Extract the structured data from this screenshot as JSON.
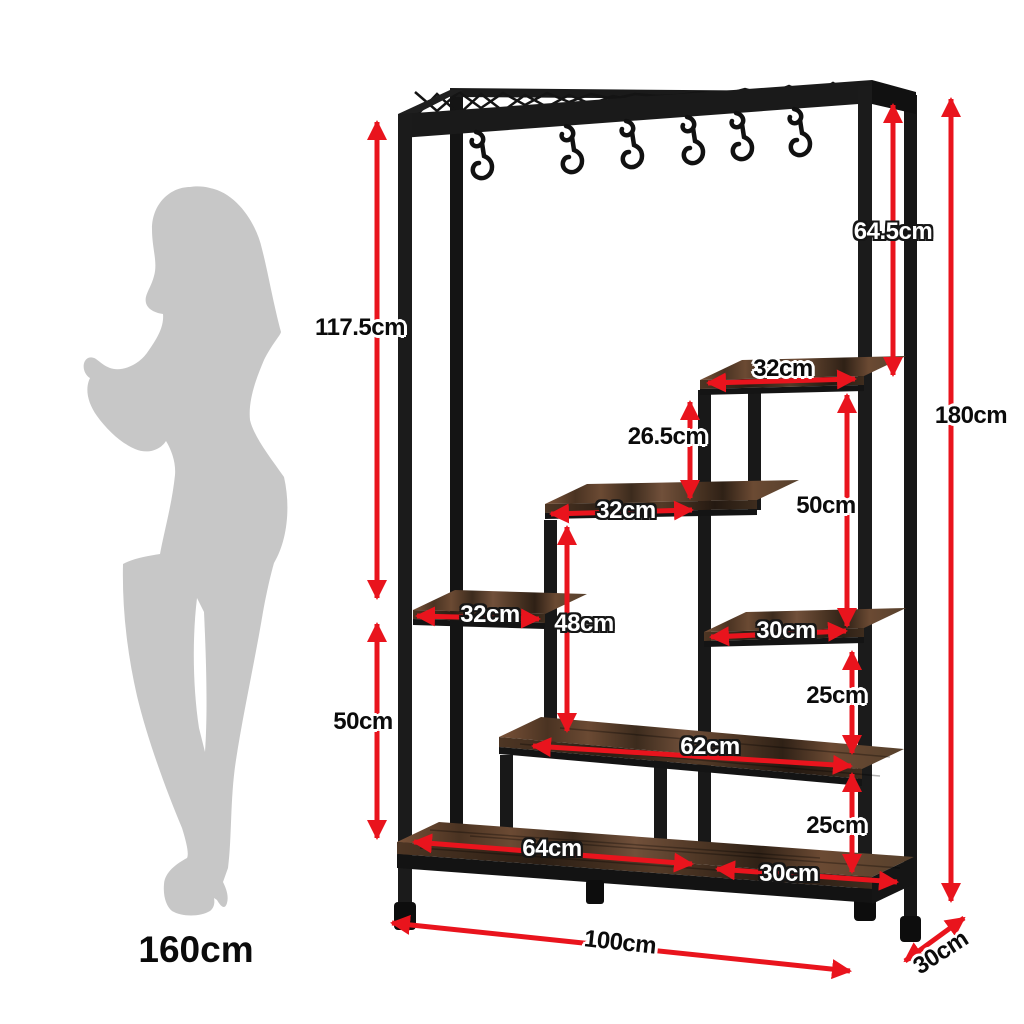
{
  "diagram": {
    "type": "furniture-dimension-diagram",
    "product": "industrial shelf rack with hanging hooks and person silhouette for scale",
    "background": "#ffffff",
    "hook_count": 6
  },
  "colors": {
    "arrow_red": "#e9141d",
    "metal_black": "#1a1a1a",
    "wood_brown": "#6b4a33",
    "silhouette_gray": "#c7c7c7",
    "label_dark": "#0b0b0b",
    "label_light": "#ffffff"
  },
  "labels": {
    "height_upper_section": "117.5cm",
    "height_lower_left": "50cm",
    "height_hook_section": "64.5cm",
    "height_total": "180cm",
    "width_top_shelf": "32cm",
    "gap_top_to_middle_shelf": "26.5cm",
    "height_right_tier": "50cm",
    "width_middle_shelf": "32cm",
    "width_left_shelf": "32cm",
    "height_middle_tier": "48cm",
    "width_right_shelf": "30cm",
    "gap_right_upper": "25cm",
    "width_long_shelf": "62cm",
    "gap_right_lower": "25cm",
    "width_bottom_left_section": "64cm",
    "width_bottom_right_section": "30cm",
    "width_total": "100cm",
    "depth_total": "30cm",
    "person_height": "160cm"
  }
}
